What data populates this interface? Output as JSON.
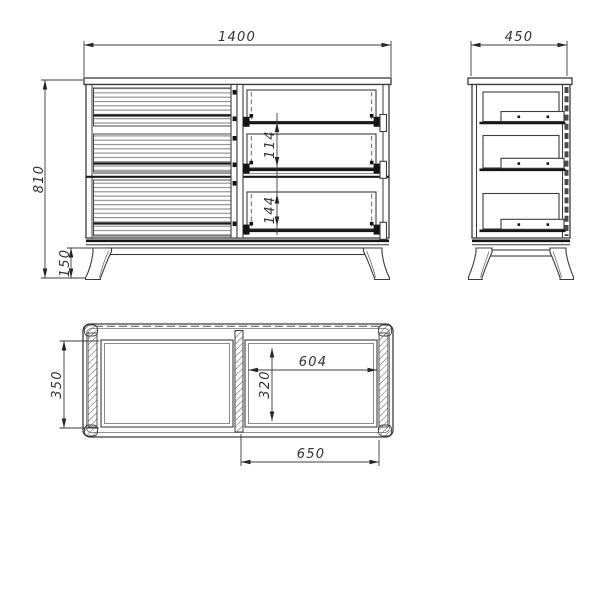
{
  "title": "Sideboard technical drawing, three orthographic views",
  "views": {
    "front": {
      "name": "front-view",
      "dims": {
        "width": "1400",
        "height": "810",
        "leg_height": "150",
        "drawer_gap_upper": "114",
        "drawer_gap_lower": "144"
      }
    },
    "side": {
      "name": "side-view",
      "dims": {
        "depth": "450"
      }
    },
    "plan": {
      "name": "plan-view",
      "dims": {
        "carcass_inner_depth": "350",
        "drawer_inner_depth": "320",
        "drawer_inner_width": "604",
        "door_width": "650"
      }
    }
  },
  "colors": {
    "line": "#3c3c3c",
    "line_dark": "#161616",
    "background": "#ffffff"
  }
}
